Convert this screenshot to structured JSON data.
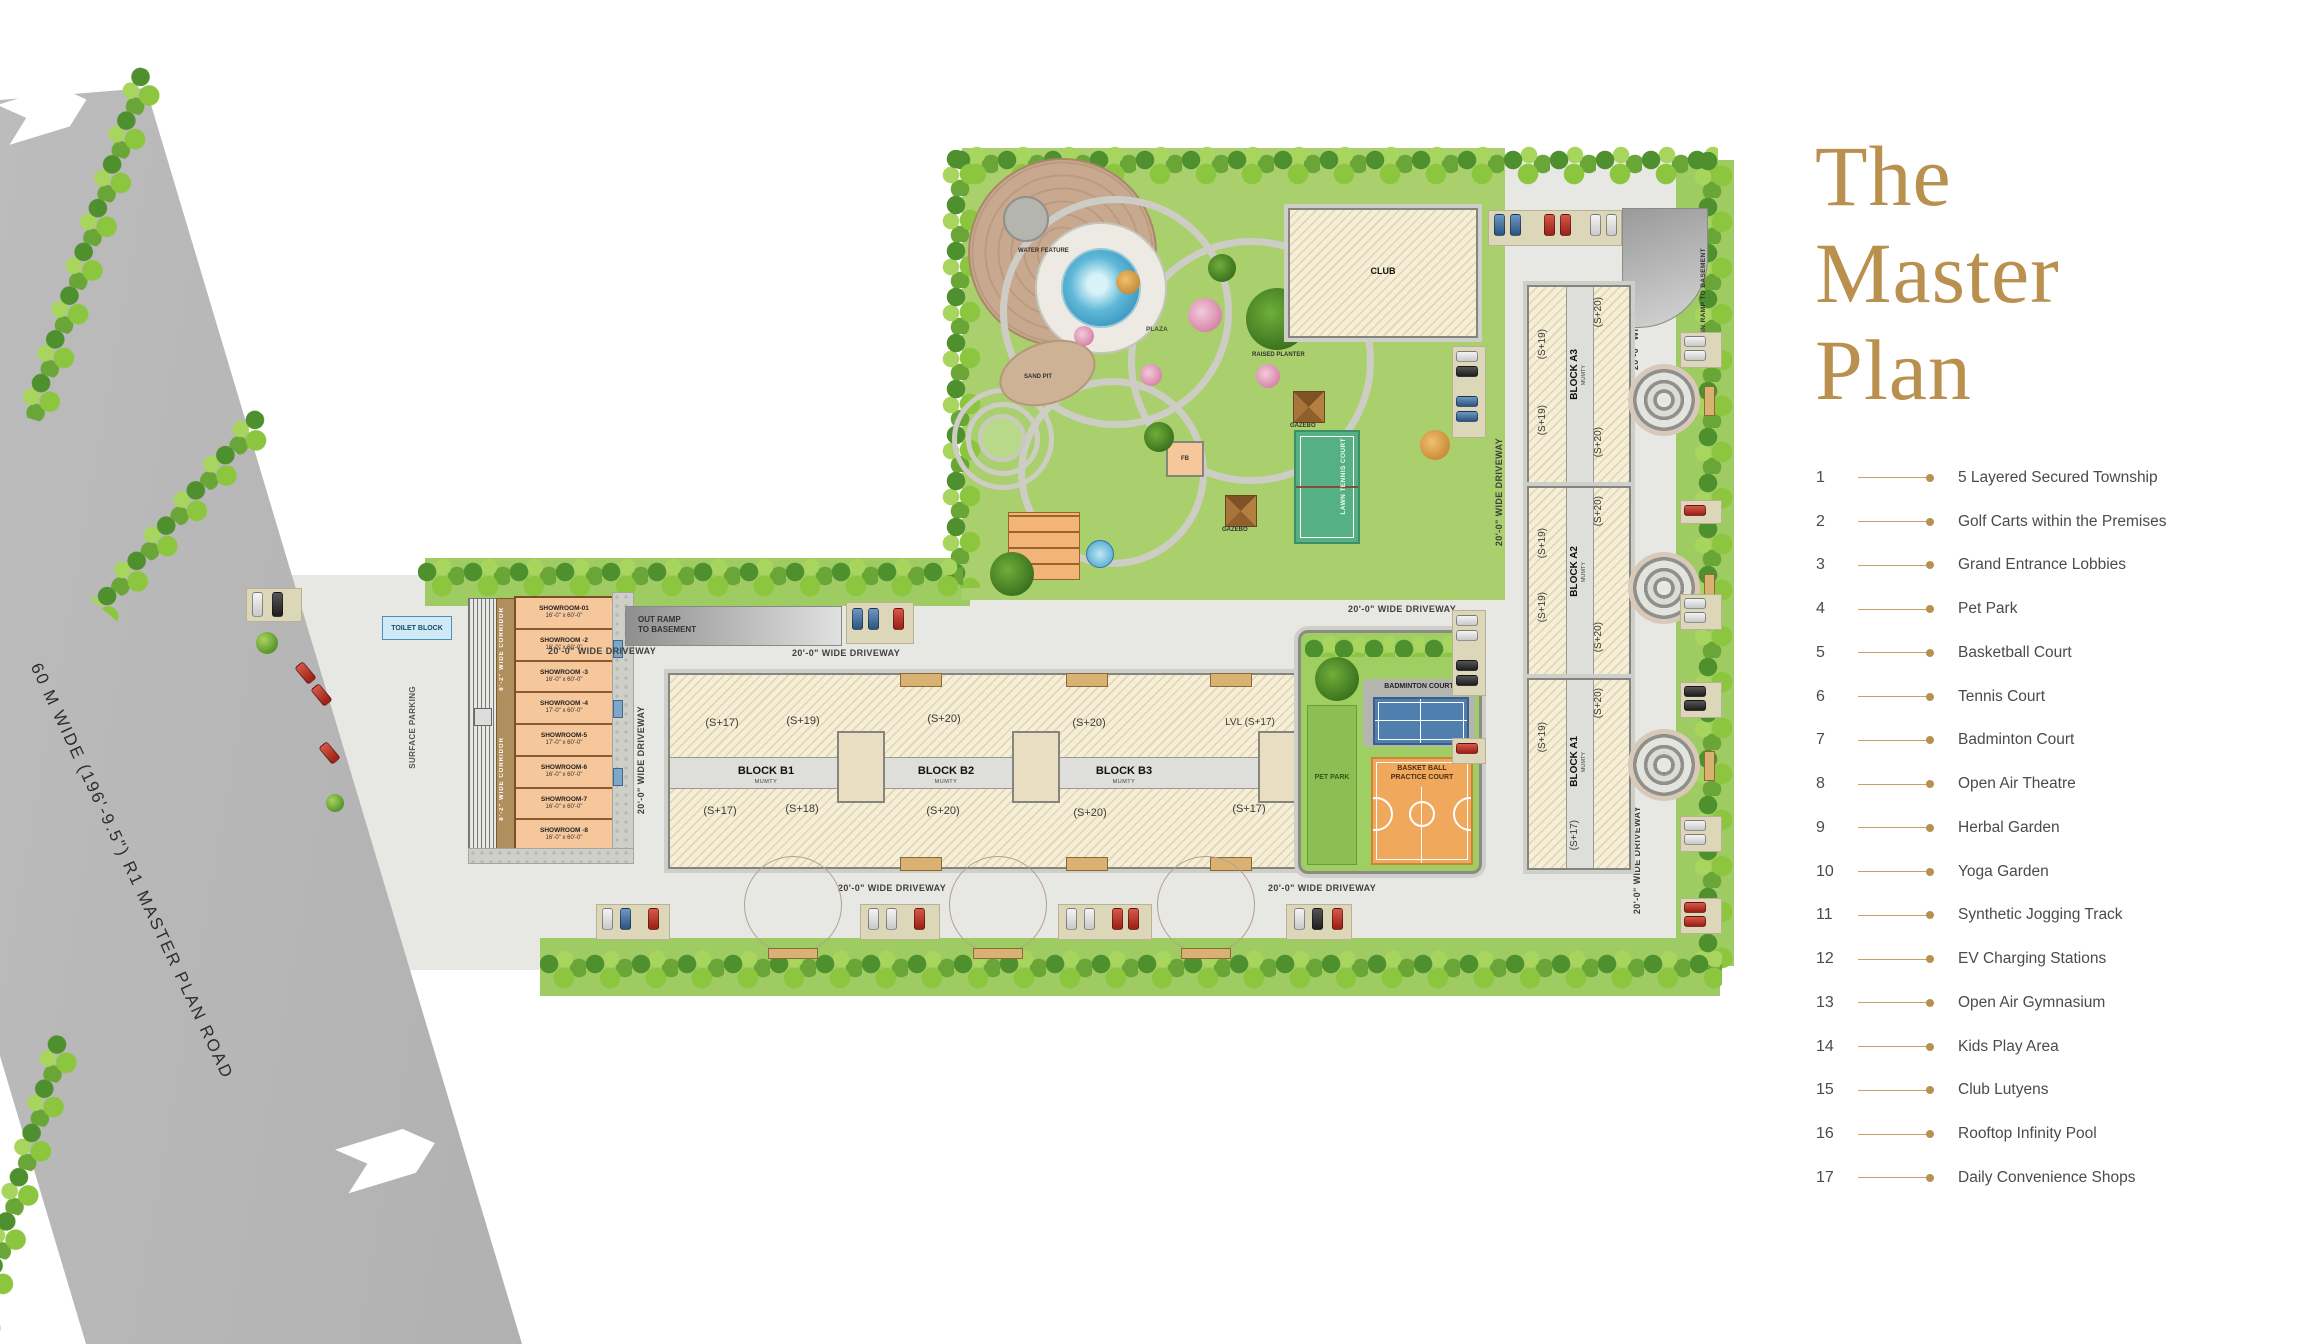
{
  "colors": {
    "accent_gold": "#b9904e",
    "legend_text": "#4b4b4d",
    "lawn_green": "#9fcb63",
    "road_gray": "#b0b0b0",
    "court_blue": "#4f7fae",
    "court_orange": "#f0a85c",
    "court_tennis_green": "#55b083",
    "showroom_peach": "#f6c79b"
  },
  "title_lines": [
    "The",
    "Master",
    "Plan"
  ],
  "legend_items": [
    {
      "num": "1",
      "label": "5 Layered Secured Township"
    },
    {
      "num": "2",
      "label": "Golf Carts within the Premises"
    },
    {
      "num": "3",
      "label": "Grand Entrance Lobbies"
    },
    {
      "num": "4",
      "label": "Pet Park"
    },
    {
      "num": "5",
      "label": "Basketball Court"
    },
    {
      "num": "6",
      "label": "Tennis Court"
    },
    {
      "num": "7",
      "label": "Badminton Court"
    },
    {
      "num": "8",
      "label": "Open Air Theatre"
    },
    {
      "num": "9",
      "label": "Herbal Garden"
    },
    {
      "num": "10",
      "label": "Yoga Garden"
    },
    {
      "num": "11",
      "label": "Synthetic Jogging Track"
    },
    {
      "num": "12",
      "label": "EV Charging Stations"
    },
    {
      "num": "13",
      "label": "Open Air Gymnasium"
    },
    {
      "num": "14",
      "label": "Kids Play Area"
    },
    {
      "num": "15",
      "label": "Club Lutyens"
    },
    {
      "num": "16",
      "label": "Rooftop Infinity Pool"
    },
    {
      "num": "17",
      "label": "Daily Convenience Shops"
    }
  ],
  "map": {
    "road_label": "60 M  WIDE (196'-9.5\") R1 MASTER PLAN ROAD",
    "driveway_label": "20'-0\" WIDE DRIVEWAY",
    "out_ramp_line1": "OUT RAMP",
    "out_ramp_line2": "TO BASEMENT",
    "in_ramp_label": "IN RAMP TO BASEMENT",
    "surface_parking": "SURFACE PARKING",
    "toilet_block": "TOILET BLOCK",
    "corridor_label": "8'-2\" WIDE CORRIDOR",
    "club_label": "CLUB",
    "mumty": "MUMTY",
    "plaza": "PLAZA",
    "water_feature": "WATER FEATURE",
    "sand_pit": "SAND PIT",
    "gazebo": "GAZEBO",
    "raised_planter": "RAISED PLANTER",
    "lawn_tennis": "LAWN TENNIS COURT",
    "pet_park": "PET PARK",
    "badminton": "BADMINTON COURT",
    "basketball_line1": "BASKET BALL",
    "basketball_line2": "PRACTICE COURT",
    "fb": "FB",
    "blocks": {
      "b1": "BLOCK B1",
      "b2": "BLOCK B2",
      "b3": "BLOCK B3",
      "a1": "BLOCK A1",
      "a2": "BLOCK A2",
      "a3": "BLOCK A3"
    },
    "b_wings_top": [
      "(S+17)",
      "(S+19)",
      "(S+20)",
      "(S+20)",
      "LVL (S+17)"
    ],
    "b_wings_bottom": [
      "(S+17)",
      "(S+18)",
      "(S+20)",
      "(S+20)",
      "(S+17)"
    ],
    "a3_wings": [
      "(S+20)",
      "(S+19)",
      "(S+19)",
      "(S+20)"
    ],
    "a2_wings": [
      "(S+20)",
      "(S+19)",
      "(S+19)",
      "(S+20)"
    ],
    "a1_wings": [
      "(S+20)",
      "(S+19)",
      "(S+17)"
    ],
    "showrooms": [
      {
        "name": "SHOWROOM-01",
        "dim": "16'-0\" x 60'-0\""
      },
      {
        "name": "SHOWROOM -2",
        "dim": "16'-0\" x 60'-0\""
      },
      {
        "name": "SHOWROOM -3",
        "dim": "16'-0\" x 60'-0\""
      },
      {
        "name": "SHOWROOM -4",
        "dim": "17'-0\" x 60'-0\""
      },
      {
        "name": "SHOWROOM-5",
        "dim": "17'-0\" x 60'-0\""
      },
      {
        "name": "SHOWROOM-6",
        "dim": "16'-0\" x 60'-0\""
      },
      {
        "name": "SHOWROOM-7",
        "dim": "16'-0\" x 60'-0\""
      },
      {
        "name": "SHOWROOM -8",
        "dim": "16'-0\" x 60'-0\""
      }
    ]
  }
}
